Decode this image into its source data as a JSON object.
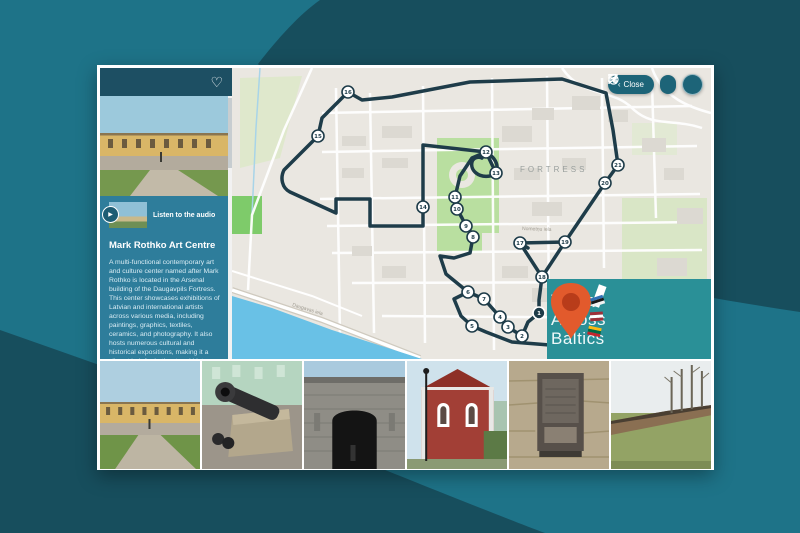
{
  "toolbar": {
    "close_chevron": "‹",
    "close_label": "Close",
    "icons": [
      "bookmark",
      "navigation",
      "compass",
      "menu"
    ]
  },
  "sidebar": {
    "favorite_icon": "heart",
    "heart_glyph": "♡",
    "audio_label": "Listen to the audio",
    "play_glyph": "▶",
    "title": "Mark Rothko Art Centre",
    "p1": "A multi-functional contemporary art and culture center named after Mark Rothko is located in the Arsenal building of the Daugavpils Fortress. This center showcases exhibitions of Latvian and international artists across various media, including paintings, graphics, textiles, ceramics, and photography. It also hosts numerous cultural and historical expositions, making it a vibrant hub for both art and history enthusiasts.",
    "p2": "The Mark Rothko Art Centre is the only place in Eastern Europe where visitors can"
  },
  "map": {
    "area_label": "FORTRESS",
    "street_labels": [
      "Daugavas iela",
      "Nometņu iela"
    ],
    "route_color": "#1e3c49",
    "route_d": "M116,24 L130,32 L160,29 L238,14 L330,11 L374,25 L381,62 L386,97 L373,115 L333,174 L288,175 L310,209 L307,232 L307,245 L296,254 L290,268 L276,259 L268,249 L252,231 L236,224 L222,231 L229,248 L240,258 L254,264 L280,274 L330,278 M116,24 L90,50 L86,68 L52,102 C48,110 50,120 58,124 L104,145 L104,131 L138,131 L138,158 L191,158 L191,77 L254,84 M254,84 C268,92 268,106 258,108 C246,110 238,102 240,94 C241,90 246,88 250,90 M254,84 L240,90 L228,108 L223,129 L225,141 L230,150 L234,158 L238,163 L241,169 L238,185 L222,190 L208,188 L214,206 L236,224 M264,105 L254,84 M288,175 L296,180 M310,209 L333,174",
    "markers": [
      {
        "n": "1",
        "x": 307,
        "y": 245,
        "sel": true
      },
      {
        "n": "2",
        "x": 290,
        "y": 268
      },
      {
        "n": "3",
        "x": 276,
        "y": 259
      },
      {
        "n": "4",
        "x": 268,
        "y": 249
      },
      {
        "n": "5",
        "x": 240,
        "y": 258
      },
      {
        "n": "6",
        "x": 236,
        "y": 224
      },
      {
        "n": "7",
        "x": 252,
        "y": 231
      },
      {
        "n": "8",
        "x": 241,
        "y": 169
      },
      {
        "n": "9",
        "x": 234,
        "y": 158
      },
      {
        "n": "10",
        "x": 225,
        "y": 141
      },
      {
        "n": "11",
        "x": 223,
        "y": 129
      },
      {
        "n": "12",
        "x": 254,
        "y": 84
      },
      {
        "n": "13",
        "x": 264,
        "y": 105
      },
      {
        "n": "14",
        "x": 191,
        "y": 139
      },
      {
        "n": "15",
        "x": 86,
        "y": 68
      },
      {
        "n": "16",
        "x": 116,
        "y": 24
      },
      {
        "n": "17",
        "x": 288,
        "y": 175
      },
      {
        "n": "18",
        "x": 310,
        "y": 209
      },
      {
        "n": "19",
        "x": 333,
        "y": 174
      },
      {
        "n": "20",
        "x": 373,
        "y": 115
      },
      {
        "n": "21",
        "x": 386,
        "y": 97
      }
    ]
  },
  "logo": {
    "line1": "Tours",
    "line2": "Across",
    "line3": "Baltics",
    "pin_color": "#e25a2c",
    "bg_color": "#2a9097"
  },
  "photos": [
    {
      "name": "arsenal-building"
    },
    {
      "name": "fortress-cannon"
    },
    {
      "name": "fortress-gate"
    },
    {
      "name": "red-brick-building"
    },
    {
      "name": "memorial-plaque"
    },
    {
      "name": "fortress-rampart"
    }
  ],
  "colors": {
    "background_base": "#1e7388",
    "background_dark": "#174e5d",
    "sidebar": "#2e7d9b",
    "sidebar_top": "#1d4f63",
    "button": "#1d6478",
    "route": "#1e3c49"
  }
}
